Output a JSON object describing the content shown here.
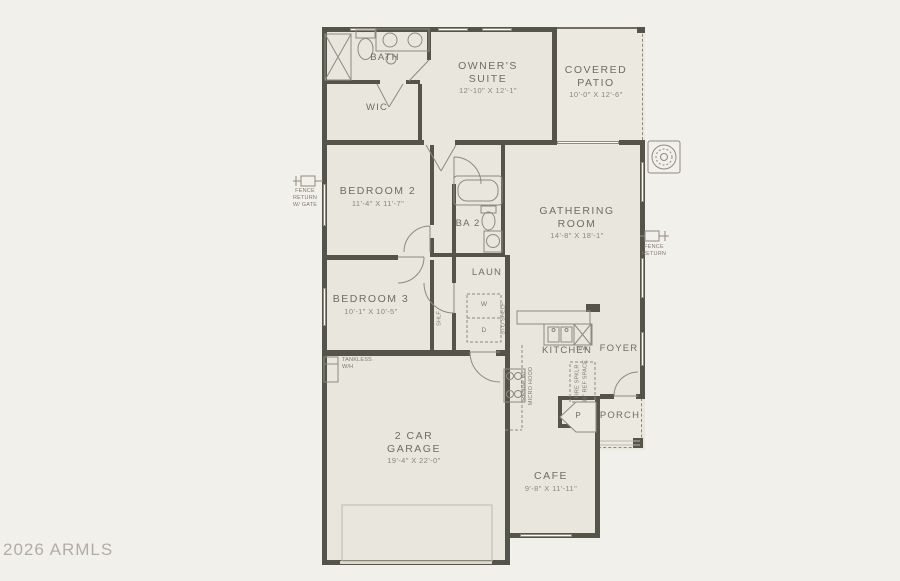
{
  "watermark": "2026 ARMLS",
  "rooms": {
    "bath": {
      "name": "BATH"
    },
    "wic": {
      "name": "WIC"
    },
    "owners_suite": {
      "name": "OWNER'S SUITE",
      "dims": "12'-10\" X 12'-1\""
    },
    "covered_patio": {
      "name": "COVERED PATIO",
      "dims": "10'-0\" X 12'-6\""
    },
    "bedroom2": {
      "name": "BEDROOM 2",
      "dims": "11'-4\" X 11'-7\""
    },
    "ba2": {
      "name": "BA 2"
    },
    "gathering_room": {
      "name": "GATHERING ROOM",
      "dims": "14'-8\" X 18'-1\""
    },
    "bedroom3": {
      "name": "BEDROOM 3",
      "dims": "10'-1\" X 10'-5\""
    },
    "laundry": {
      "name": "LAUN"
    },
    "kitchen": {
      "name": "KITCHEN"
    },
    "foyer": {
      "name": "FOYER"
    },
    "porch": {
      "name": "PORCH"
    },
    "garage": {
      "name": "2 CAR GARAGE",
      "dims": "19'-4\" X 22'-0\""
    },
    "cafe": {
      "name": "CAFE",
      "dims": "9'-8\" X 11'-11\""
    }
  },
  "labels": {
    "fence_return_gate": "FENCE RETURN W/ GATE",
    "fence_return": "FENCE RETURN",
    "tankless_wh": "TANKLESS W/H",
    "dishwasher": "D/W",
    "washer": "W",
    "dryer": "D",
    "sto_shelf": "STO SHELF",
    "shelf": "SHLF",
    "range_micro": "RANGE W/ MICRO HOOD",
    "ref_space": "36\" REF SPACE",
    "riser": "FIRE SPKLR",
    "pantry": "P"
  },
  "colors": {
    "background": "#f2f0ea",
    "room_fill": "#e9e6dd",
    "wall": "#55544a",
    "text": "#6f6e64"
  }
}
